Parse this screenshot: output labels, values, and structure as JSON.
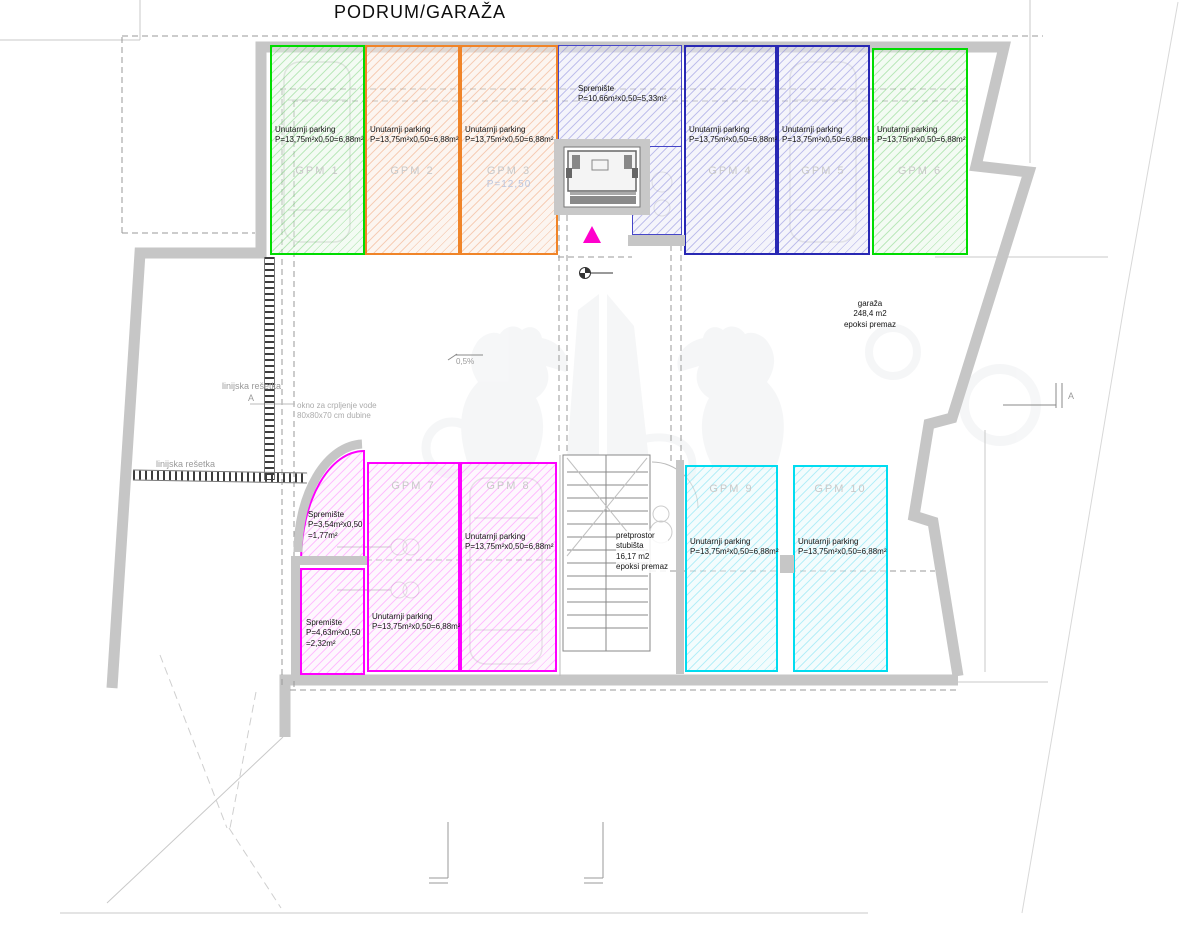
{
  "title": "PODRUM/GARAŽA",
  "colors": {
    "green": "#00dc00",
    "orange": "#f08428",
    "blue": "#2828b4",
    "magenta": "#ff00ff",
    "cyan": "#00dcf0",
    "wall_gray": "#c6c6c6",
    "entrance_triangle": "#ff00cc"
  },
  "stalls": [
    {
      "id": "GPM  1",
      "color": "green",
      "line1": "Unutarnji parking",
      "line2": "P=13,75m²x0,50=6,88m²"
    },
    {
      "id": "GPM  2",
      "color": "orange",
      "line1": "Unutarnji parking",
      "line2": "P=13,75m²x0,50=6,88m²"
    },
    {
      "id": "GPM  3",
      "color": "orange",
      "line1": "Unutarnji parking",
      "line2": "P=13,75m²x0,50=6,88m²",
      "extra": "P=12,50"
    },
    {
      "id": "GPM  4",
      "color": "blue",
      "line1": "Unutarnji parking",
      "line2": "P=13,75m²x0,50=6,88m²"
    },
    {
      "id": "GPM  5",
      "color": "blue",
      "line1": "Unutarnji parking",
      "line2": "P=13,75m²x0,50=6,88m²"
    },
    {
      "id": "GPM  6",
      "color": "green",
      "line1": "Unutarnji parking",
      "line2": "P=13,75m²x0,50=6,88m²"
    },
    {
      "id": "GPM  7",
      "color": "magenta",
      "line1": "Unutarnji parking",
      "line2": "P=13,75m²x0,50=6,88m²"
    },
    {
      "id": "GPM  8",
      "color": "magenta",
      "line1": "Unutarnji parking",
      "line2": "P=13,75m²x0,50=6,88m²"
    },
    {
      "id": "GPM  9",
      "color": "cyan",
      "line1": "Unutarnji parking",
      "line2": "P=13,75m²x0,50=6,88m²"
    },
    {
      "id": "GPM 10",
      "color": "cyan",
      "line1": "Unutarnji parking",
      "line2": "P=13,75m²x0,50=6,88m²"
    }
  ],
  "storage_top": {
    "name": "Spremište",
    "calc": "P=10,66m²x0,50=5,33m²"
  },
  "storage_a": {
    "name": "Spremište",
    "calc": "P=3,54m²x0,50",
    "result": "=1,77m²"
  },
  "storage_b": {
    "name": "Spremište",
    "calc": "P=4,63m²x0,50",
    "result": "=2,32m²"
  },
  "garage_label": {
    "name": "garaža",
    "area": "248,4 m2",
    "finish": "epoksi premaz"
  },
  "lobby_label": {
    "line1": "pretprostor",
    "line2": "stubišta",
    "line3": "16,17 m2",
    "line4": "epoksi premaz"
  },
  "annotations": {
    "slope": "0,5%",
    "grate_label_1": "linijska rešetka",
    "grate_label_1_sub": "A",
    "grate_label_2": "linijska rešetka",
    "sump_line1": "okno za crpljenje vode",
    "sump_line2": "80x80x70 cm dubine",
    "section_marker_right": "A"
  }
}
